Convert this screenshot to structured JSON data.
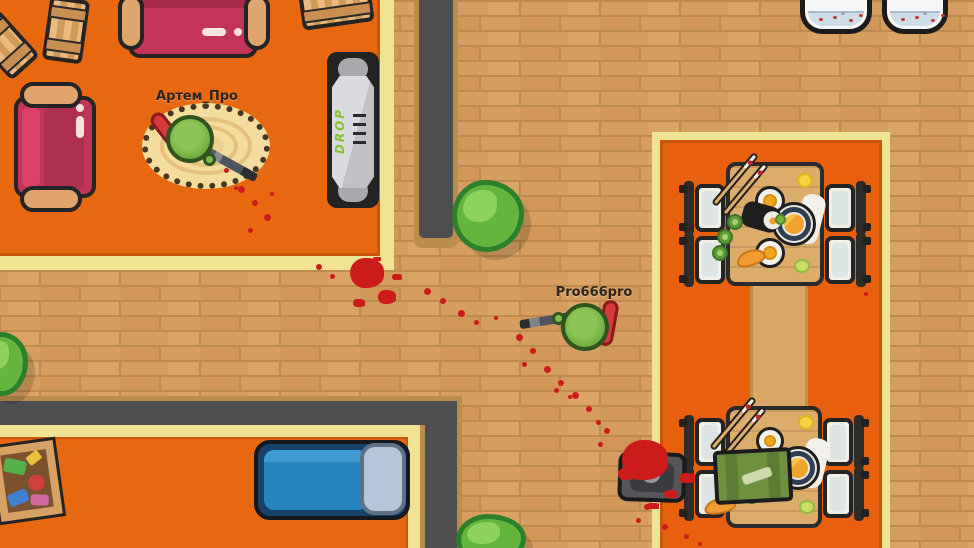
{
  "game": {
    "players": [
      {
        "name": "Артем_Про",
        "skin_color": "#6FAD3F",
        "backpack_color": "#D63A3A",
        "weapon": "sniper-rifle"
      },
      {
        "name": "Pro666pro",
        "skin_color": "#6FAD3F",
        "backpack_color": "#D63A3A",
        "weapon": "rifle"
      }
    ],
    "treadmill_text": "DROP",
    "colors": {
      "room_floor": "#E8680F",
      "dining_floor": "#E8600E",
      "walkway_brick": "#D59E60",
      "brick_mortar": "#BE8B4E",
      "wall": "#4E4E50",
      "wall_trim": "#B98D4D",
      "room_edge": "#F0E494",
      "blood": "#CB1B1B",
      "bush": "#64B53E",
      "table_wood": "#DCAC6B",
      "sofa": "#C23458",
      "bed": "#2585BE"
    }
  }
}
